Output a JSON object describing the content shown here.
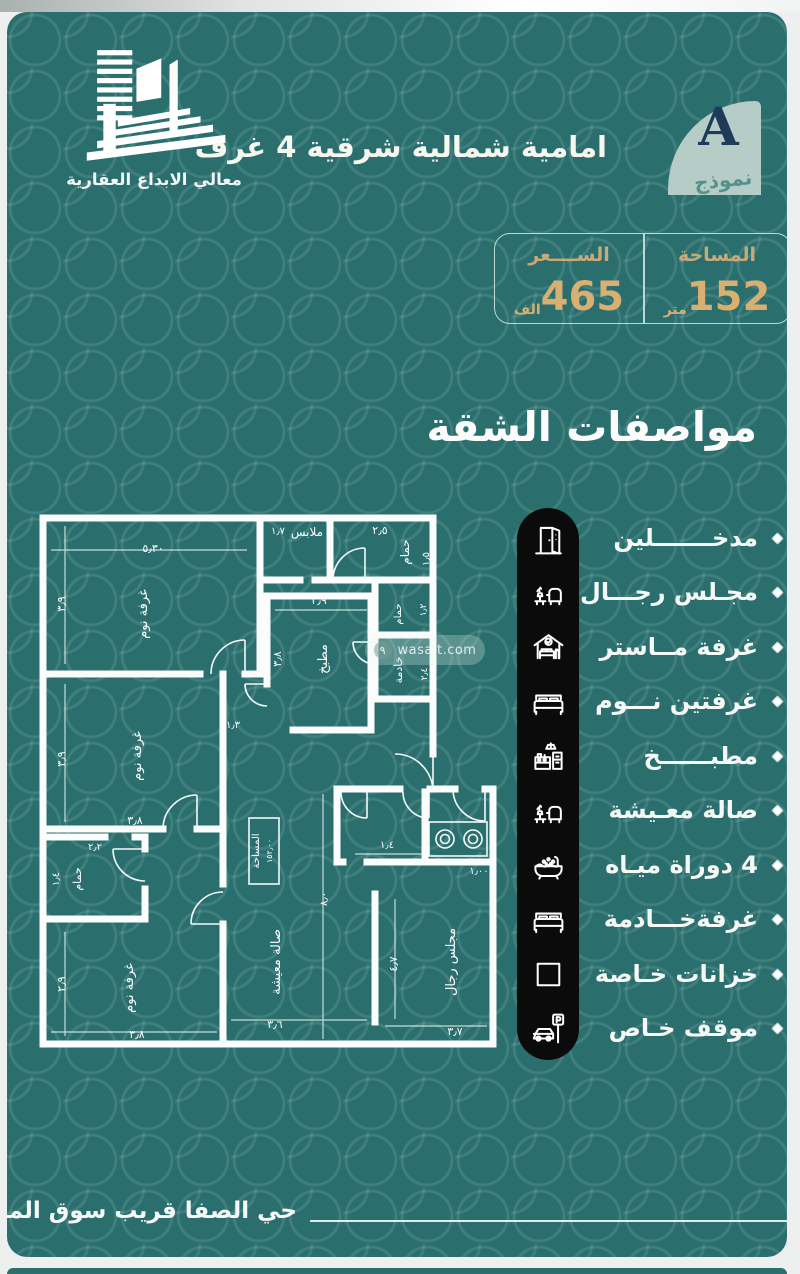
{
  "brand": {
    "name": "معالي الابداع العقارية"
  },
  "header": {
    "title": "امامية شمالية شرقية  4 غرف",
    "model_letter": "A",
    "model_word": "نموذج"
  },
  "info_table": {
    "area_label": "المساحة",
    "area_value": "152",
    "area_unit": "متر",
    "price_label": "الســــعر",
    "price_value": "465",
    "price_unit": "الف"
  },
  "section_title": "مواصفات الشقة",
  "features": [
    {
      "icon": "door-icon",
      "label": "مدخـــــــلين"
    },
    {
      "icon": "majlis-sofa-icon",
      "label": "مجـلس رجـــال"
    },
    {
      "icon": "master-bedroom-icon",
      "label": "غرفة مــاستر"
    },
    {
      "icon": "bed-icon",
      "label": "غرفتين نـــوم"
    },
    {
      "icon": "kitchen-icon",
      "label": "مطبــــــخ"
    },
    {
      "icon": "living-sofa-icon",
      "label": "صالة معـيشة"
    },
    {
      "icon": "bathtub-icon",
      "label": "4 دوراة ميـاه"
    },
    {
      "icon": "maid-bed-icon",
      "label": "غرفةخـــادمة"
    },
    {
      "icon": "closet-square-icon",
      "label": "خزانات خـاصة"
    },
    {
      "icon": "parking-icon",
      "label": "موقف خـاص"
    }
  ],
  "floor_plan": {
    "watermark": "wasalt.com",
    "watermark_badge": "٩",
    "area_box": [
      "المساحة",
      "١٥٢٫٠٠"
    ],
    "labels": [
      {
        "t": "٥٫٣٠",
        "x": 118,
        "y": 48,
        "r": 0,
        "s": 11
      },
      {
        "t": "٣٫٩",
        "x": 30,
        "y": 100,
        "r": -90,
        "s": 11
      },
      {
        "t": "غرفة نوم",
        "x": 112,
        "y": 110,
        "r": -90,
        "s": 13
      },
      {
        "t": "١٫٧",
        "x": 243,
        "y": 30,
        "r": 0,
        "s": 10
      },
      {
        "t": "ملابس",
        "x": 272,
        "y": 32,
        "r": 0,
        "s": 12
      },
      {
        "t": "٢٫٥",
        "x": 345,
        "y": 30,
        "r": 0,
        "s": 11
      },
      {
        "t": "حمام",
        "x": 374,
        "y": 48,
        "r": -90,
        "s": 12
      },
      {
        "t": "١٫٥",
        "x": 394,
        "y": 55,
        "r": -90,
        "s": 10
      },
      {
        "t": "٢٫٩",
        "x": 284,
        "y": 100,
        "r": 0,
        "s": 11
      },
      {
        "t": "مطبخ",
        "x": 292,
        "y": 155,
        "r": -90,
        "s": 13
      },
      {
        "t": "٣٫٨",
        "x": 246,
        "y": 155,
        "r": -90,
        "s": 11
      },
      {
        "t": "حمام",
        "x": 366,
        "y": 110,
        "r": -90,
        "s": 10
      },
      {
        "t": "١٫٢",
        "x": 391,
        "y": 106,
        "r": -90,
        "s": 9
      },
      {
        "t": "خادمة",
        "x": 367,
        "y": 166,
        "r": -90,
        "s": 11
      },
      {
        "t": "٢٫٤",
        "x": 392,
        "y": 170,
        "r": -90,
        "s": 9
      },
      {
        "t": "غرفة نوم",
        "x": 106,
        "y": 252,
        "r": -90,
        "s": 13
      },
      {
        "t": "٣٫٩",
        "x": 30,
        "y": 255,
        "r": -90,
        "s": 11
      },
      {
        "t": "٣٫٨",
        "x": 100,
        "y": 320,
        "r": 0,
        "s": 11
      },
      {
        "t": "٢٫٢",
        "x": 60,
        "y": 346,
        "r": 0,
        "s": 10
      },
      {
        "t": "حمام",
        "x": 46,
        "y": 375,
        "r": -90,
        "s": 11
      },
      {
        "t": "١٫٤",
        "x": 24,
        "y": 375,
        "r": -90,
        "s": 10
      },
      {
        "t": "غرفة نوم",
        "x": 98,
        "y": 484,
        "r": -90,
        "s": 13
      },
      {
        "t": "٢٫٩",
        "x": 30,
        "y": 480,
        "r": -90,
        "s": 11
      },
      {
        "t": "٣٫٨",
        "x": 102,
        "y": 534,
        "r": 0,
        "s": 11
      },
      {
        "t": "١٫٣",
        "x": 198,
        "y": 224,
        "r": 0,
        "s": 10
      },
      {
        "t": "صالة معيشة",
        "x": 245,
        "y": 458,
        "r": -90,
        "s": 13
      },
      {
        "t": "٣٫٦",
        "x": 240,
        "y": 524,
        "r": 0,
        "s": 11
      },
      {
        "t": "٨٫٠",
        "x": 292,
        "y": 395,
        "r": -90,
        "s": 10
      },
      {
        "t": "مجلس رجال",
        "x": 420,
        "y": 458,
        "r": -90,
        "s": 13
      },
      {
        "t": "٤٫٧",
        "x": 362,
        "y": 460,
        "r": -90,
        "s": 11
      },
      {
        "t": "٣٫٧",
        "x": 420,
        "y": 531,
        "r": 0,
        "s": 11
      },
      {
        "t": "١٫٤",
        "x": 352,
        "y": 344,
        "r": 0,
        "s": 10
      },
      {
        "t": "١٫٠٠",
        "x": 444,
        "y": 370,
        "r": 0,
        "s": 10
      }
    ]
  },
  "footer": {
    "location": "حي الصفا قريب سوق المرجان"
  },
  "colors": {
    "teal_bg": "#2a6f6e",
    "gold_value": "#d9af72",
    "gold_header": "#c9a978",
    "navy_letter": "#1e3c5a",
    "badge_bg": "#b6cdc7",
    "pill_black": "#0b0b0b",
    "white": "#ffffff"
  }
}
